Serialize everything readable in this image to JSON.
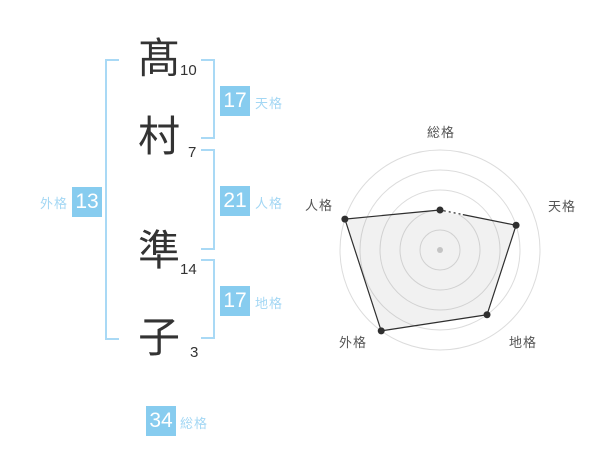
{
  "name_panel": {
    "chars": [
      {
        "char": "髙",
        "strokes": "10"
      },
      {
        "char": "村",
        "strokes": "7"
      },
      {
        "char": "準",
        "strokes": "14"
      },
      {
        "char": "子",
        "strokes": "3"
      }
    ],
    "kaku": {
      "tenkaku": {
        "value": "17",
        "label": "天格"
      },
      "jinkaku": {
        "value": "21",
        "label": "人格"
      },
      "chikaku": {
        "value": "17",
        "label": "地格"
      },
      "gaikaku": {
        "value": "13",
        "label": "外格"
      },
      "soukaku": {
        "value": "34",
        "label": "総格"
      }
    },
    "colors": {
      "badge": "#87ccef",
      "badge_text": "#ffffff",
      "label": "#a3d7f4",
      "bracket": "#a9d9f5",
      "name_text": "#333333"
    }
  },
  "chart_data": {
    "type": "radar",
    "axes": [
      "総格",
      "天格",
      "地格",
      "外格",
      "人格"
    ],
    "values": [
      2,
      4,
      4,
      5,
      5
    ],
    "scale_max": 5,
    "ring_count": 5,
    "center_x": 440,
    "center_y": 250,
    "radius": 100,
    "start_angle_deg": -90,
    "grid": true,
    "legend": "none",
    "colors": {
      "ring": "#dcdcdc",
      "line": "#2f2f2f",
      "dot": "#2f2f2f",
      "fill": "rgba(120,120,120,0.10)",
      "center_dot": "#c4c4c4",
      "label": "#555555"
    }
  }
}
